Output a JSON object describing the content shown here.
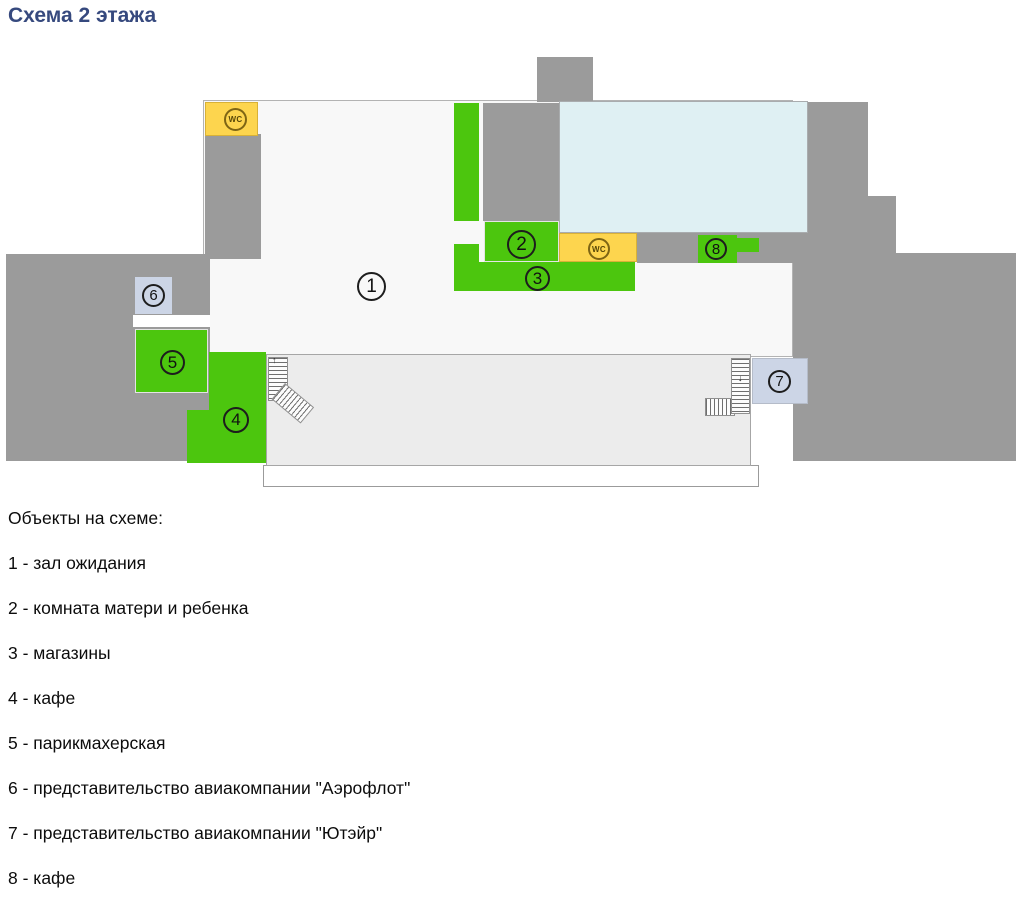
{
  "title": "Схема 2 этажа",
  "plan": {
    "wc_label": "WC",
    "markers": [
      {
        "num": "1"
      },
      {
        "num": "2"
      },
      {
        "num": "3"
      },
      {
        "num": "4"
      },
      {
        "num": "5"
      },
      {
        "num": "6"
      },
      {
        "num": "7"
      },
      {
        "num": "8"
      }
    ],
    "colors": {
      "facility_green": "#4cc60e",
      "wc_yellow": "#fdd54e",
      "hall_light_blue": "#dff0f3",
      "wall_gray": "#9b9b9b",
      "office_blue_gray": "#ccd5e6",
      "title_blue": "#36497e"
    }
  },
  "legend": {
    "heading": "Объекты на схеме:",
    "items": [
      "1 - зал ожидания",
      "2 - комната матери и ребенка",
      "3 - магазины",
      "4 - кафе",
      "5 - парикмахерская",
      "6 - представительство авиакомпании \"Аэрофлот\"",
      "7 - представительство авиакомпании \"Ютэйр\"",
      "8 - кафе"
    ]
  }
}
